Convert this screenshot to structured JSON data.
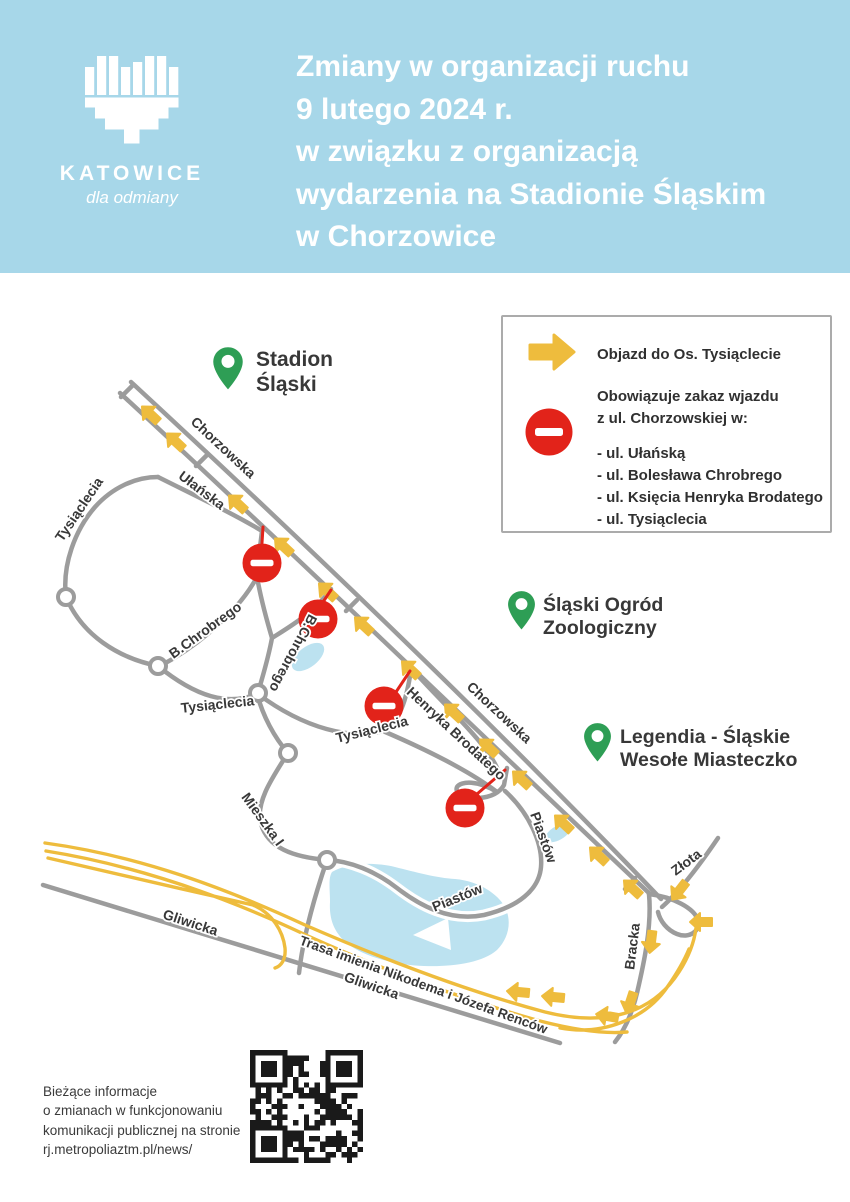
{
  "header": {
    "logo_city": "KATOWICE",
    "logo_tagline": "dla odmiany",
    "title_lines": [
      "Zmiany w organizacji ruchu",
      "9 lutego 2024 r.",
      "w związku z organizacją",
      "wydarzenia na Stadionie Śląskim",
      "w Chorzowice"
    ]
  },
  "legend": {
    "detour_label": "Objazd do Os. Tysiąclecie",
    "ban_intro_lines": [
      "Obowiązuje zakaz wjazdu",
      "z ul. Chorzowskiej w:"
    ],
    "ban_streets": [
      "- ul. Ułańską",
      "- ul. Bolesława Chrobrego",
      "- ul. Księcia Henryka Brodatego",
      "- ul. Tysiąclecia"
    ]
  },
  "map": {
    "pins": [
      {
        "label_lines": [
          "Stadion",
          "Śląski"
        ]
      },
      {
        "label_lines": [
          "Śląski Ogród",
          "Zoologiczny"
        ]
      },
      {
        "label_lines": [
          "Legendia - Śląskie",
          "Wesołe Miasteczko"
        ]
      }
    ],
    "street_labels": [
      "Chorzowska",
      "Ułańska",
      "Tysiąclecia",
      "B.Chrobrego",
      "B.Chrobrego",
      "Tysiąclecia",
      "Tysiąclecia",
      "Henryka Brodatego",
      "Chorzowska",
      "Piastów",
      "Piastów",
      "Mieszka I",
      "Gliwicka",
      "Gliwicka",
      "Trasa imienia Nikodema i Józefa Renców",
      "Bracka",
      "Złota"
    ]
  },
  "footer": {
    "info_lines": [
      "Bieżące informacje",
      "o zmianach w funkcjonowaniu",
      "komunikacji publicznej na stronie",
      "rj.metropoliaztm.pl/news/"
    ]
  },
  "colors": {
    "header_bg": "#a7d7e9",
    "title_text": "#ffffff",
    "road_gray": "#9c9c9c",
    "detour_yellow": "#eebc3d",
    "ban_red": "#e2231a",
    "pin_green": "#2e9e55",
    "water_blue": "#bce2f0",
    "label_dark": "#383838"
  },
  "icons": {
    "detour-arrow-icon": "yellow right arrow",
    "no-entry-icon": "red circle with white bar",
    "location-pin-icon": "green map marker",
    "logo-heart-icon": "white bar heart",
    "qr-code": "QR code"
  }
}
